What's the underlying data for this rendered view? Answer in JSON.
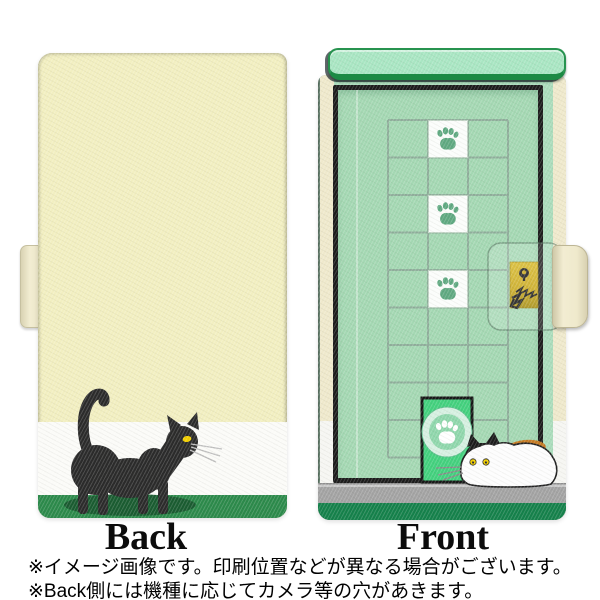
{
  "labels": {
    "back": "Back",
    "front": "Front"
  },
  "disclaimer": {
    "line1": "※イメージ画像です。印刷位置などが異なる場合がございます。",
    "line2": "※Back側には機種に応じてカメラ等の穴があきます。"
  },
  "design": {
    "product": "flip wallet smartphone case, two-sided product view",
    "back_motif": "black walking cat on cream background with white stripe and green ground",
    "front_motif": "mint-green door with tiled window grid, three white paw-print tiles, gold lock plate with claw scratches, bright green pet door with paw emblem, calico cat sniffing at pet door",
    "paw_tile_count": 3
  },
  "colors": {
    "back_cream": "#f2efc1",
    "back_white_stripe": "#fbfbf8",
    "back_green": "#2c8a4b",
    "front_mint": "#aadcbb",
    "door_mint": "#a4d8b3",
    "door_frame_black": "#1c1c1c",
    "grid_line": "#8fae9b",
    "paw_green": "#5fa981",
    "pet_door_green": "#43d17e",
    "lintel_mint": "#a9e6c3",
    "lintel_border_green": "#1c8a44",
    "lock_gold": "#c7a513",
    "floor_gray": "#a3a3a3",
    "front_bottom_green": "#15814b",
    "edge_cream": "#efe9cc",
    "cat_black": "#2b2b2b",
    "calico_orange": "#c57a22",
    "eye_yellow": "#f2cf00",
    "cat_shadow_green": "#1a5c31"
  }
}
